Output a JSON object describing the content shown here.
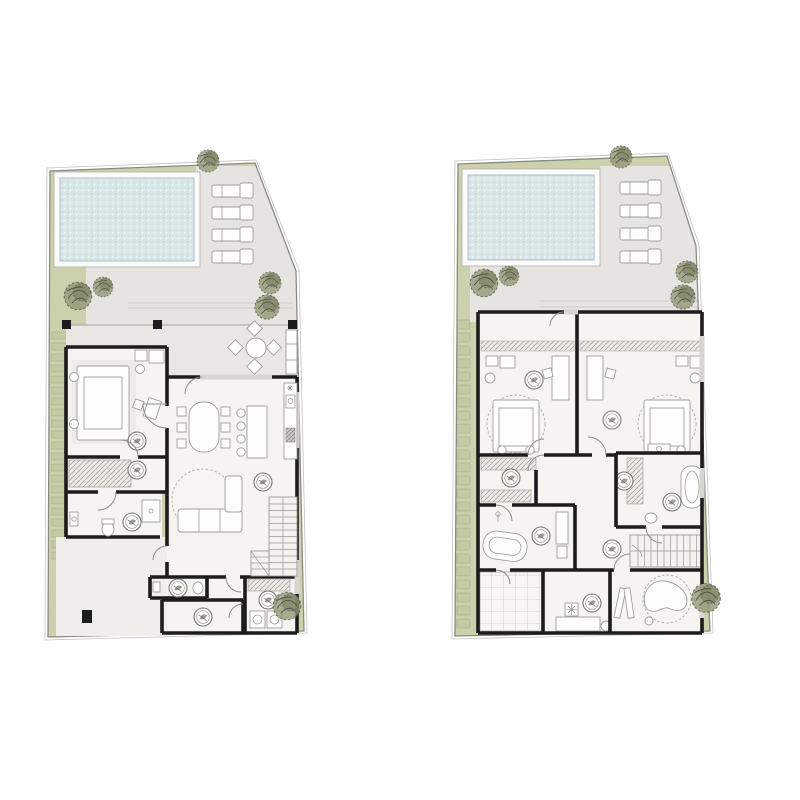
{
  "scene": {
    "type": "architectural-floor-plan-pair",
    "plans": [
      {
        "name": "left-floor-plan",
        "pool": true,
        "loungers": 4,
        "trees": 6,
        "plant_markers": 8
      },
      {
        "name": "right-floor-plan",
        "pool": true,
        "loungers": 4,
        "trees": 6,
        "plant_markers": 8
      }
    ]
  },
  "colors": {
    "page": "#ffffff",
    "green": "#ccd1ad",
    "green_dark": "#b4ba92",
    "step": "#c3c9a2",
    "terrace": "#e6e4e0",
    "terrace2": "#e9e7e3",
    "deck": "#fbfbfa",
    "water": "#d9e7e9",
    "water_dot": "#c6dbde",
    "floor": "#f5f4f1",
    "patio": "#efeeea",
    "wall": "#1c1c1c",
    "boundary": "#8b8a83",
    "furniture_fill": "#fdfdfc",
    "furniture_stroke": "#a09e98",
    "tree_fill": "#939878",
    "tree_stroke": "#555a48"
  },
  "icons": {
    "tree": "sketchy-dashed-circle",
    "potted-plant": "double-circle-with-leaf",
    "lounger": "rect-with-pillow",
    "door-swing": "quarter-arc",
    "staircase": "tread-lines",
    "pool-water": "dotted-texture"
  }
}
